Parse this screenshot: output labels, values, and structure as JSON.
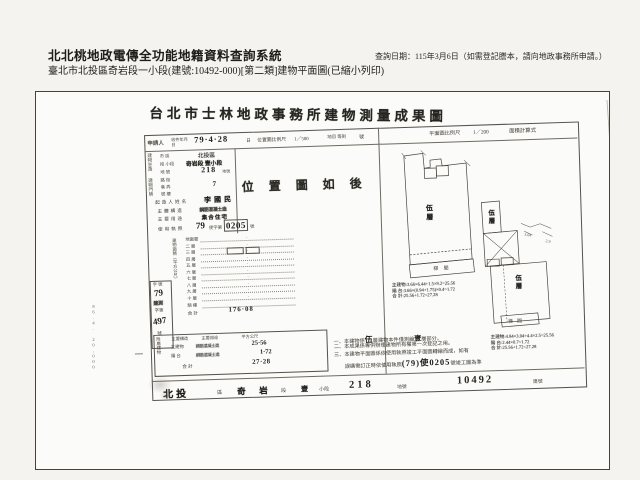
{
  "header": {
    "system_title": "北北桃地政電傳全功能地籍資料查詢系統",
    "query_date": "查詢日期：115年3月6日（如需登記謄本，請向地政事務所申請。）",
    "subtitle": "臺北市北投區奇岩段一小段(建號:10492-000)[第二類]建物平面圖(已縮小列印)"
  },
  "doc": {
    "title": "台北市士林地政事務所建物測量成果圖",
    "top": {
      "applicant": "申請人",
      "date_label": "收件年月日",
      "date": "79·4·28",
      "date_suffix": "日",
      "loc_scale_label": "位置圖比例尺",
      "loc_scale": "1／500",
      "land_label": "地目 等則",
      "num_label": "號",
      "plan_scale_label": "平面圖比例尺",
      "plan_scale": "1／200",
      "calc_label": "面積計算式"
    },
    "loc_note": "位 置 圖 如 後",
    "group_site": "建物坐落",
    "site_rows": [
      {
        "k": "市 區",
        "v": "北投區"
      },
      {
        "k": "段 小段",
        "v": "奇岩段 壹小段"
      },
      {
        "k": "地 號",
        "v": "218"
      }
    ],
    "site_no_suffix": "地號",
    "group_door": "建物門牌",
    "door_rows": [
      {
        "k": "路 街",
        "v": ""
      },
      {
        "k": "巷 弄",
        "v": "7"
      },
      {
        "k": "號 樓",
        "v": ""
      }
    ],
    "owner_k": "起造人姓名",
    "owner_v": "李國民",
    "struct_k": "主體構造",
    "struct_v": "鋼筋混凝土造",
    "use_k": "主要用途",
    "use_v": "集合住宅",
    "lic_k": "使用執照",
    "lic_pre": "79",
    "lic_mid": "使字第",
    "lic_num": "0205",
    "lic_suf": "號",
    "area_col": "建物面積（平方公尺）",
    "floors": [
      {
        "k": "地面層",
        "v": "·"
      },
      {
        "k": "二 層",
        "v": "·"
      },
      {
        "k": "三 層",
        "v": "·"
      },
      {
        "k": "四 層",
        "v": "·"
      },
      {
        "k": "五 層",
        "v": "·"
      },
      {
        "k": "六 層",
        "v": "·"
      },
      {
        "k": "七 層",
        "v": "·"
      },
      {
        "k": "八 層",
        "v": "·"
      },
      {
        "k": "九 層",
        "v": "·"
      },
      {
        "k": "十 層",
        "v": "·"
      }
    ],
    "arcade_k": "騎 樓",
    "total_k": "合 計",
    "total_v": "176·08",
    "serial": {
      "h": "字 號",
      "year": "79",
      "mid": "建測",
      "zidi": "字第",
      "num": "497",
      "suf": "號"
    },
    "annex": {
      "h": "附屬建物",
      "c1": "主要構造",
      "c2": "主要用途",
      "c3": "平方公尺",
      "rows": [
        {
          "a": "主建物",
          "b": "鋼筋混凝土造",
          "c": "25·56"
        },
        {
          "a": "陽 台",
          "b": "鋼筋混凝土造",
          "c": "1·72"
        }
      ],
      "tk": "合 計",
      "tv": "27·28"
    },
    "notes": {
      "n1a": "一、本建物係",
      "n1b": "伍",
      "n1c": "層建物本件僅測繪",
      "n1d": "壹",
      "n1e": "層部分。",
      "n2": "二、本成果係專供辦理建物所有權第一次登記之用。",
      "n3a": "三、本建物平面圖係依使用執照竣工平面圖轉繪而成，如有",
      "n3b": "　　誤繕需訂正時依使用執照",
      "n3big": "(79)使0205",
      "n3c": "號竣工圖為準"
    },
    "plans": {
      "left_label": "伍層",
      "left_stair": "梯 間",
      "left_calc1": "主建物:3.66×6.44+1.5×9.2=25.56",
      "left_calc2": "陽 台:3.66×(0.94+1.75)×0.4=1.72",
      "left_calc3": "合 計:25.56+1.72=27.28",
      "up_label": "伍層",
      "low_label": "伍層",
      "low_stair": "梯 間",
      "right_calc1": "主建物:4.84×3.04+4.4×2.5=25.56",
      "right_calc2": "陽 台:2.44×0.7=1.72",
      "right_calc3": "合 計:25.56+1.72=27.28",
      "dim_a": "3.04",
      "dim_b": "2.9"
    },
    "footer": {
      "d": "北投",
      "ds": "區",
      "s1": "奇",
      "s2": "岩",
      "ss": "段",
      "sub": "壹",
      "subs": "小段",
      "land": "218",
      "lands": "地號",
      "bld": "10492",
      "blds": "建號"
    },
    "edge_note": "86.4. 20,000"
  }
}
